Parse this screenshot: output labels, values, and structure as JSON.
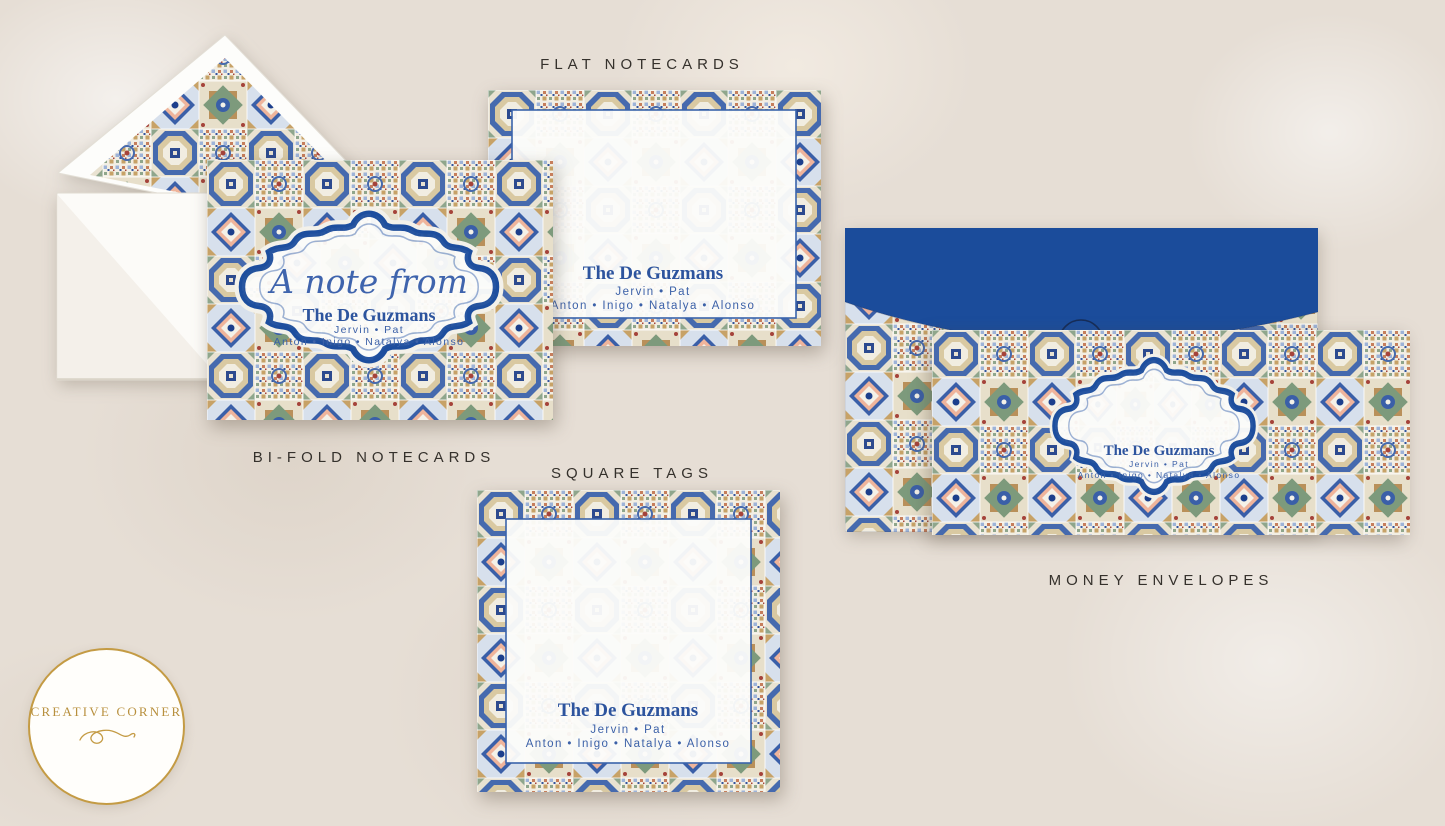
{
  "page": {
    "background_color": "#e6ded5",
    "description": "Stationery mockup sheet with Moroccan tile pattern products"
  },
  "labels": {
    "flat": "FLAT NOTECARDS",
    "bifold": "BI-FOLD NOTECARDS",
    "square": "SQUARE TAGS",
    "money": "MONEY ENVELOPES"
  },
  "family": {
    "script_intro": "A note from",
    "name": "The De Guzmans",
    "parents": "Jervin • Pat",
    "children": "Anton • Inigo • Natalya • Alonso"
  },
  "logo": {
    "text": "CREATIVE CORNER"
  },
  "colors": {
    "royal_blue": "#1b4c9b",
    "frame_blue": "#1d4e9e",
    "text_blue": "#2d549e",
    "gold": "#c49b44",
    "pattern_tan": "#c7a267",
    "pattern_sage": "#8fa68c",
    "pattern_coral": "#efb49b",
    "background": "#e6ded5"
  },
  "icons": {
    "flourish": "infinity-flourish"
  }
}
